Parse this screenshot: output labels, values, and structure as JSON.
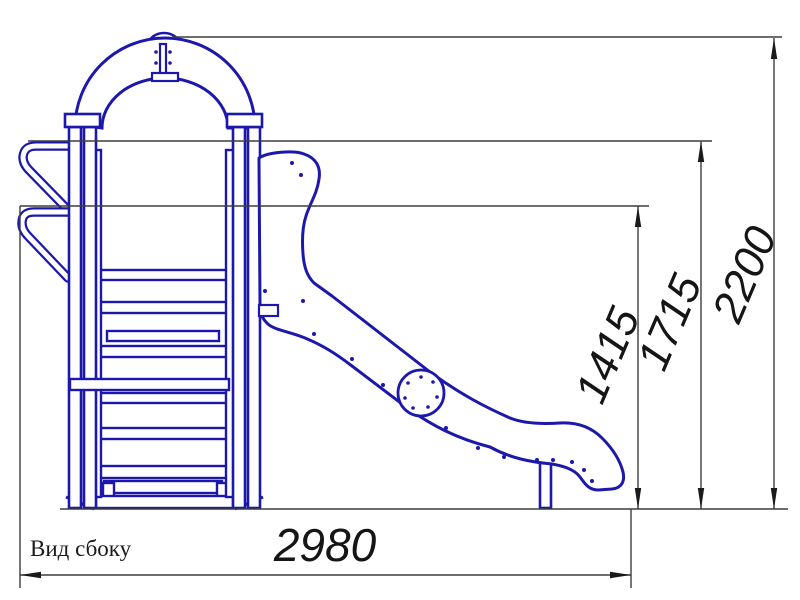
{
  "drawing": {
    "view_label": "Вид сбоку",
    "dimensions": {
      "overall_width": "2980",
      "overall_height": "2200",
      "upper_handrail_height": "1715",
      "lower_handrail_height": "1415"
    },
    "colors": {
      "structure_outline": "#1c18ac",
      "dimension_line": "#3d3d3d",
      "arrow_and_text": "#151515",
      "background": "#ffffff"
    }
  }
}
